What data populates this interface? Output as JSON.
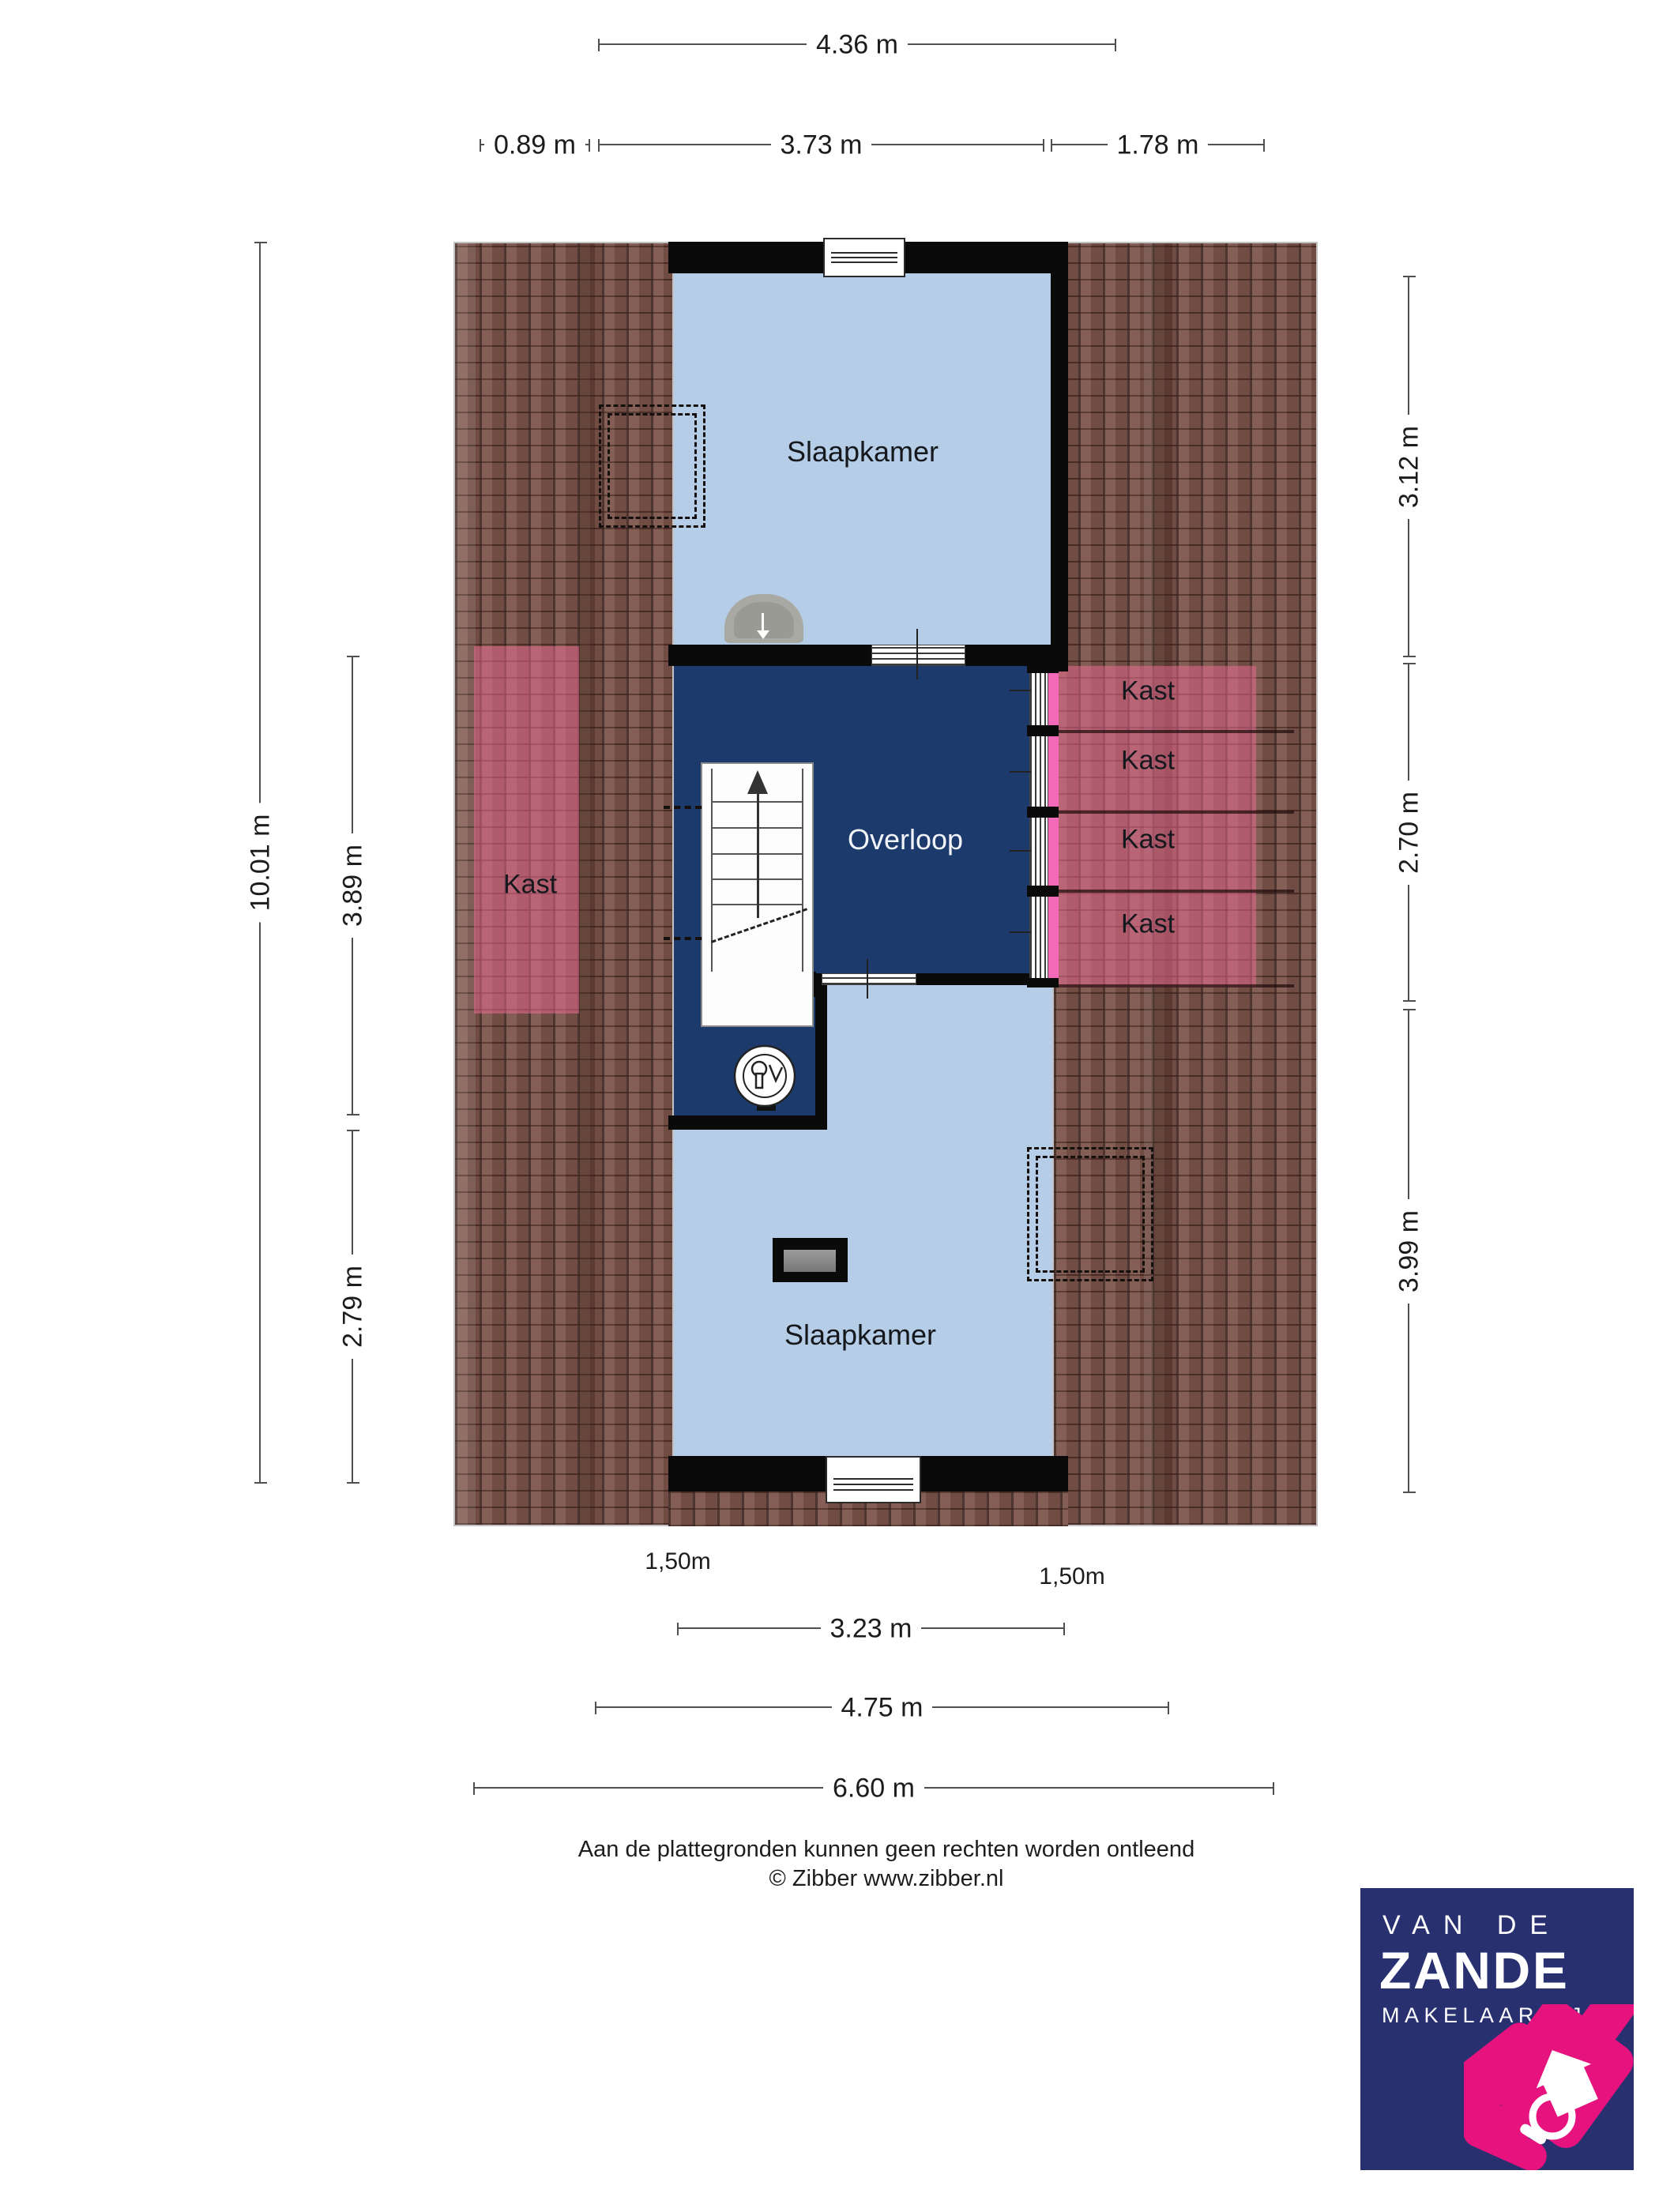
{
  "rooms": {
    "slaapkamer_top": "Slaapkamer",
    "overloop": "Overloop",
    "slaapkamer_bottom": "Slaapkamer",
    "kast_left": "Kast",
    "kast_right": [
      "Kast",
      "Kast",
      "Kast",
      "Kast"
    ]
  },
  "dimensions": {
    "width_total": "4.36 m",
    "width_row2": [
      "0.89 m",
      "3.73 m",
      "1.78 m"
    ],
    "left_total": "10.01 m",
    "left_inner": [
      "3.89 m",
      "2.79 m"
    ],
    "right": [
      "3.12 m",
      "2.70 m",
      "3.99 m"
    ],
    "bottom": [
      "3.23 m",
      "4.75 m",
      "6.60 m"
    ],
    "headroom_left": "1,50m",
    "headroom_right": "1,50m"
  },
  "footer": {
    "disclaimer": "Aan de plattegronden kunnen geen rechten worden ontleend",
    "credit": "© Zibber www.zibber.nl"
  },
  "logo": {
    "top": "VAN DE",
    "name": "ZANDE",
    "sub": "MAKELAARDIJ"
  },
  "colors": {
    "room_blue": "#b6cde7",
    "hall_navy": "#1c3a6c",
    "roof_brown": "#7d554b",
    "closet_pink": "#f56ab8",
    "logo_navy": "#293070",
    "logo_pink": "#e6127d"
  }
}
